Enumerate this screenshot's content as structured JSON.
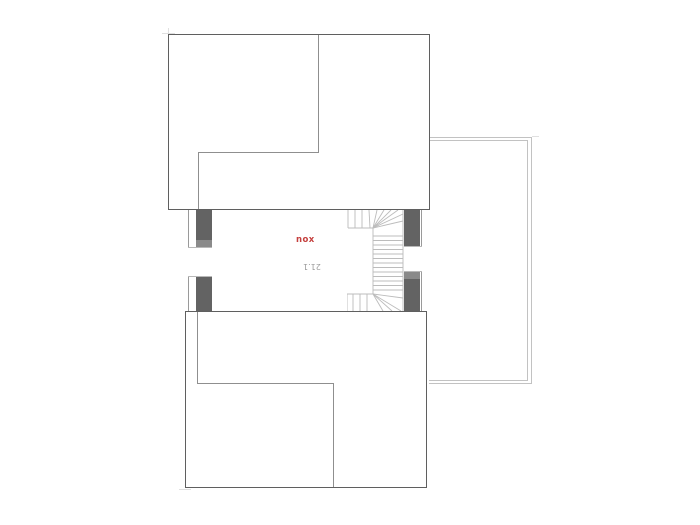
{
  "plan": {
    "hall": {
      "label": "nox",
      "area": "21.1"
    },
    "colors": {
      "bg": "#ffffff",
      "outline": "#5f5f5f",
      "partition": "#8f8f8f",
      "face_line": "#9a9a9a",
      "wall_fill": "#636363",
      "wall_fill_light": "#8a8a8a",
      "frame_line": "#b8b8b8",
      "stair_line": "#bcbcbc",
      "terrace_line": "#c2c2c2",
      "tick": "#e0e0e0",
      "label_red": "#c5403e",
      "area_gray": "#9c9c9c"
    }
  }
}
